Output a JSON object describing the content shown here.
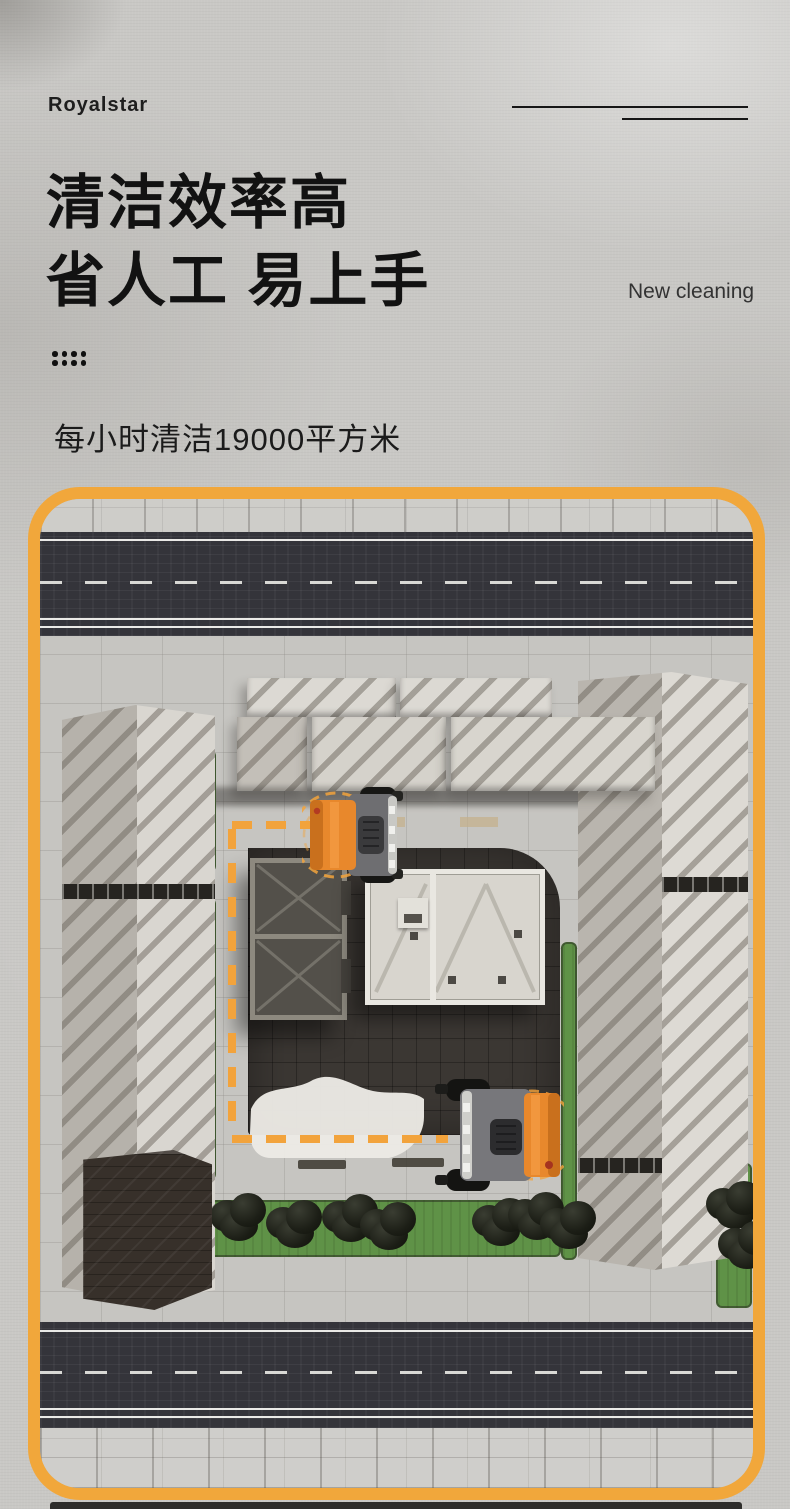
{
  "header": {
    "brand": "Royalstar",
    "heading_line1": "清洁效率高",
    "heading_line2": "省人工 易上手",
    "tagline": "New cleaning",
    "subtitle": "每小时清洁19000平方米"
  },
  "illustration": {
    "scene": "aerial-view-cleaning-route",
    "vehicles": [
      {
        "name": "sweeper-upper"
      },
      {
        "name": "sweeper-lower"
      }
    ],
    "colors": {
      "frame_border": "#F1A73B",
      "route_dash": "#F2A33C",
      "sweeper_orange": "#E8882C",
      "grass": "#5F9247",
      "asphalt": "#34343A",
      "plaza": "#3B3733",
      "pavement": "#C6C5C1"
    }
  }
}
